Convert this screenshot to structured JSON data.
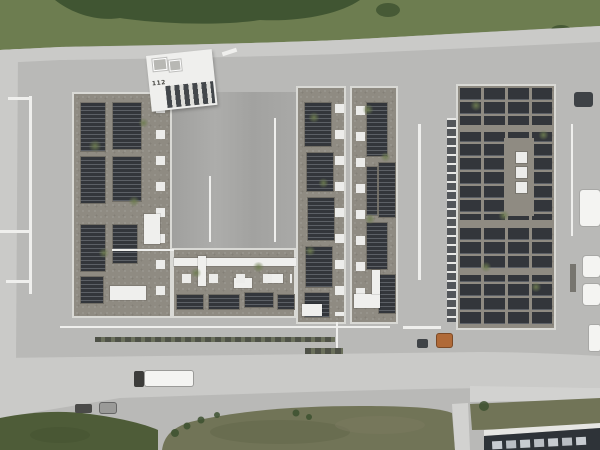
{
  "scene": {
    "description": "Aerial top-down drone photograph of an industrial fire-station complex: U-shaped building and halls with rooftop solar arrays, skylights, concrete aprons, perimeter roads, a white semi-trailer truck and green fields",
    "roof_marking": "112"
  },
  "colors": {
    "pavement": "#b9b9b7",
    "pavement_light": "#d2d2d0",
    "courtyard": "#a6a6a4",
    "road": "#cacac8",
    "grass_top": "#6d7d50",
    "tree": "#3d5130",
    "meadow": "#4e5c38",
    "field": "#717457",
    "roof_gravel": "#8f8b82",
    "solar_dark": "#33363b",
    "solar_light": "#5c6066",
    "skylight": "#ececea",
    "white_structure": "#efefed",
    "parapet": "#d9d9d5",
    "facade_dark": "#53565a",
    "truck_white": "#f4f4f2",
    "cab_dark": "#3c3c3a",
    "container_orange": "#b06a38",
    "dark_roof": "#2e3338",
    "dark_roof_panel": "#c7ccd1"
  }
}
